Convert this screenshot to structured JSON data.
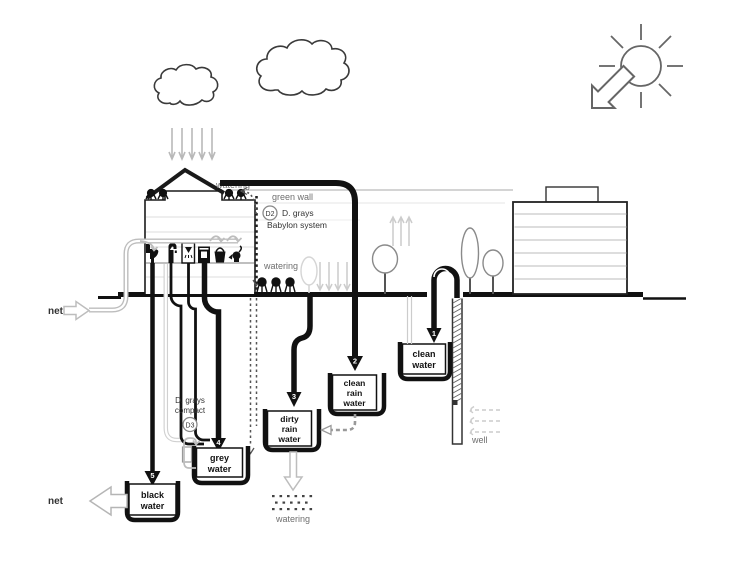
{
  "title": "water flow scheme",
  "labels": {
    "net_supply": "net",
    "net_discharge": "net",
    "watering_roof": "watering",
    "watering_garden": "watering",
    "watering_bottom": "watering",
    "green_wall": "green wall",
    "d2_badge": "D2",
    "d2_name": "D. grays",
    "d2_system": "Babylon system",
    "d3_name": "D. grays",
    "d3_type": "compact",
    "d3_badge": "D3",
    "well": "well"
  },
  "tanks": {
    "black_water": {
      "lines": [
        "black",
        "water"
      ],
      "arrow_number": "5"
    },
    "grey_water": {
      "lines": [
        "grey",
        "water"
      ],
      "arrow_number": "4"
    },
    "dirty_rain_water": {
      "lines": [
        "dirty",
        "rain",
        "water"
      ],
      "arrow_number": "3"
    },
    "clean_rain_water": {
      "lines": [
        "clean",
        "rain",
        "water"
      ],
      "arrow_number": "2"
    },
    "clean_water": {
      "lines": [
        "clean",
        "water"
      ],
      "arrow_number": "1"
    }
  },
  "icons": {
    "weather": [
      "cloud-icon",
      "cloud-icon",
      "rain-arrows-icon",
      "sun-reuse-icon"
    ],
    "fixtures": [
      "toilet-icon",
      "tap-icon",
      "shower-icon",
      "washing-machine-icon",
      "bucket-icon",
      "kettle-icon"
    ],
    "vegetation": [
      "roof-plant-icon",
      "watering-plant-icon",
      "tree-icon",
      "poplar-tree-icon"
    ]
  },
  "colors": {
    "ink": "#111111",
    "pipe_grey": "#bdbdbd",
    "faint_line": "#dddddd",
    "text_grey": "#6f6f6f",
    "tree_outline": "#8a8a8a"
  }
}
